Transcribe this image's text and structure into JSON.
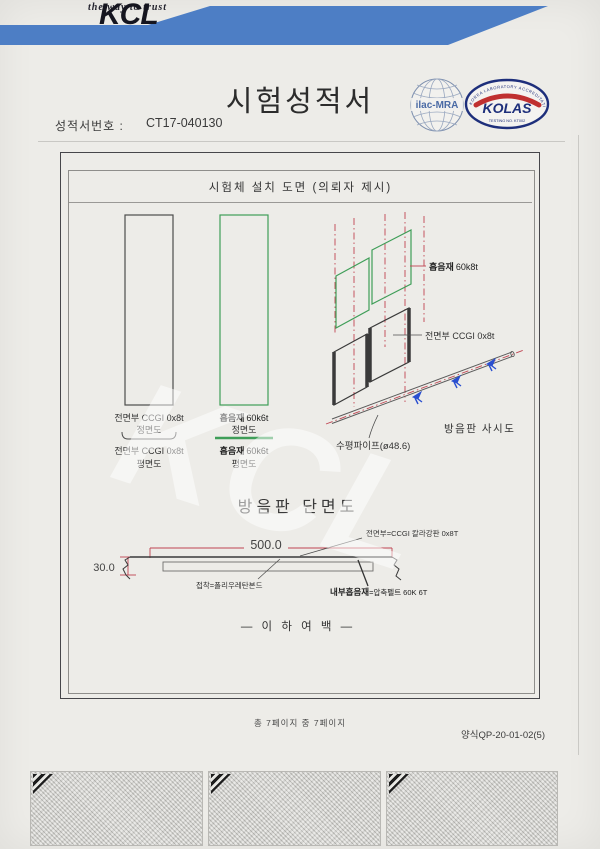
{
  "header": {
    "tagline": "the way to trust",
    "brand": "KCL",
    "title": "시험성적서",
    "report_no_label": "성적서번호 :",
    "report_no": "CT17-040130"
  },
  "accreditation": {
    "ilac_label": "ilac-MRA",
    "kolas_label": "KOLAS",
    "kolas_ring_text": "KOREA LABORATORY ACCREDITATION SCHEME",
    "kolas_bottom_text": "TESTING NO. KT002"
  },
  "drawing": {
    "box_title": "시험체 설치 도면 (의뢰자 제시)",
    "front_panel": {
      "spec": "전면부 CCGI 0x8t",
      "front_caption": "정면도",
      "plan_spec": "전면부 CCGI 0x8t",
      "plan_caption": "평면도"
    },
    "absorber_panel": {
      "name": "흡음재",
      "spec": "60k6t",
      "front_caption": "정면도",
      "plan_name": "흡음재",
      "plan_spec": "60k6t",
      "plan_caption": "평면도"
    },
    "isometric": {
      "absorber_name": "흡음재",
      "absorber_spec": "60k8t",
      "front_spec": "전면부 CCGI 0x8t",
      "pipe_label": "수평파이프(ø48.6)",
      "caption": "방음판 사시도"
    },
    "section": {
      "title": "방음판 단면도",
      "width_dim": "500.0",
      "height_dim": "30.0",
      "front_note": "전면부=CCGI 칼라강판 0x8T",
      "adhesive_note": "접착=폴리우레탄본드",
      "absorber_note_bold": "내부흡음재",
      "absorber_note_rest": "=압축펠트 60K 6T"
    },
    "end_note": "— 이 하 여 백 —"
  },
  "footer": {
    "page_info": "총 7페이지 중 7페이지",
    "form_no": "양식QP-20-01-02(5)"
  },
  "watermark": "KCL",
  "colors": {
    "banner_blue": "#4d7ec5",
    "line_red": "#c04552",
    "line_green": "#3f9e58",
    "clamp_blue": "#2a4fd0",
    "kolas_navy": "#1e2f7b",
    "kolas_red": "#c03030"
  }
}
